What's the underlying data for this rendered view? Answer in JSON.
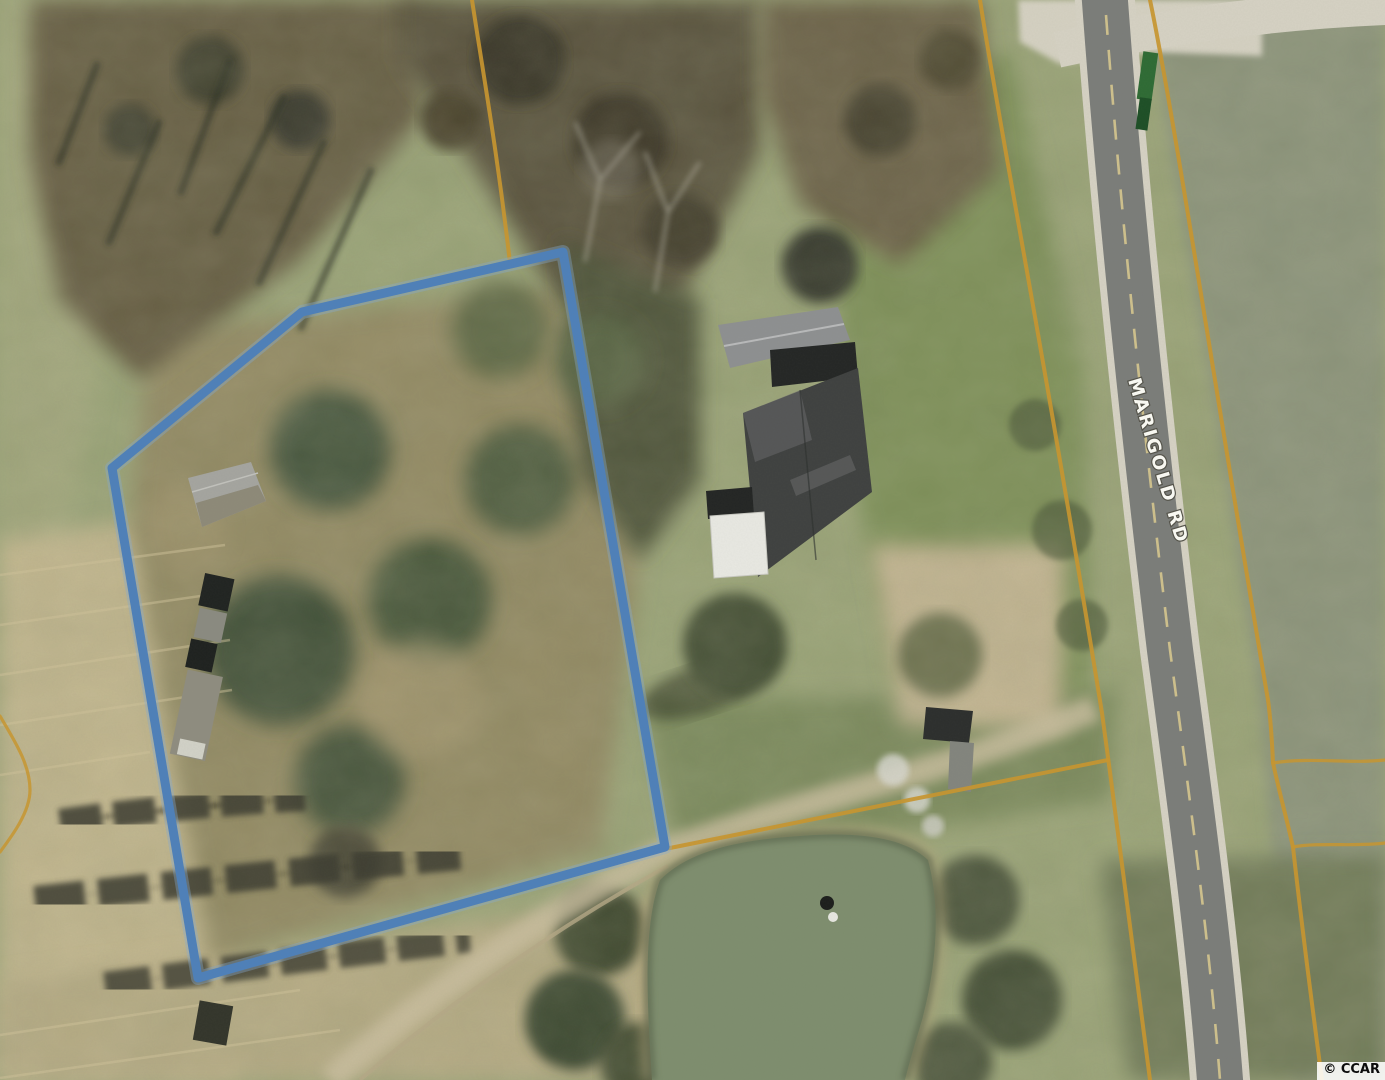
{
  "map": {
    "type": "aerial-parcel-photo",
    "road_label": "MARIGOLD RD",
    "watermark": "© CCAR"
  },
  "colors": {
    "boundary_blue": "#4e80ba",
    "boundary_blue_halo": "#85abd3",
    "parcel_orange": "#c9962f",
    "road_asphalt": "#7b7d7a",
    "road_shoulder": "#d6d2c4",
    "road_centerline": "#d8c98f",
    "pond": "#7e8e6e",
    "field_base": "#9aa478"
  },
  "features": {
    "highlight_boundary_points": "563,252 302,312 112,468 198,978 665,847",
    "parcel_lines": {
      "northwest": "M472,0 C483,73 497,150 510,263",
      "road_west": "M980,0 C1000,130 1040,330 1102,713 C1120,845 1138,985 1150,1080",
      "south_spur": "M665,849 C790,823 950,792 1108,760",
      "road_east": "M1150,0 C1175,120 1220,420 1268,700 C1271,722 1272,740 1273,763 C1280,795 1287,820 1293,847 C1300,910 1310,990 1322,1080",
      "east_spur_upper": "M1273,763 C1310,757 1350,764 1385,760",
      "east_spur_lower": "M1293,847 C1320,842 1355,847 1385,843",
      "west_edge_corner": "M0,716 C14,740 30,764 30,790 C30,812 12,836 0,852"
    },
    "road_path": "M1106,15 C1122,230 1146,450 1170,650 C1192,815 1210,950 1220,1080",
    "side_road_path": "M1075,46 C1170,26 1270,12 1385,7"
  }
}
